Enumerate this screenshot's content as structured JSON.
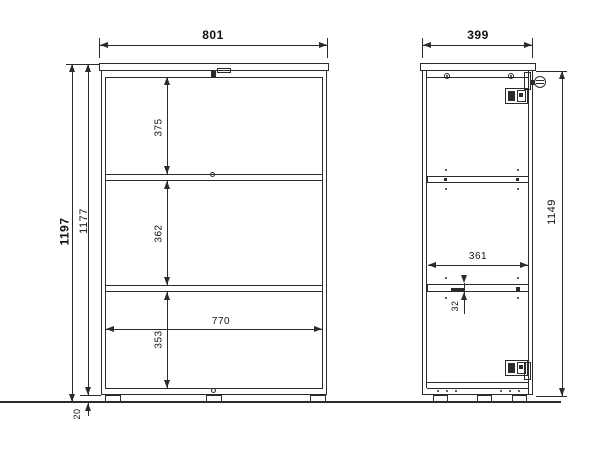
{
  "drawing": {
    "colors": {
      "background": "#ffffff",
      "line": "#2b2b2b",
      "text": "#111111"
    },
    "front_view": {
      "width": "801",
      "inner_width": "770",
      "total_height": "1197",
      "carcass_height": "1177",
      "top_section_height": "375",
      "middle_section_height": "362",
      "bottom_section_height": "353",
      "foot_height": "20"
    },
    "side_view": {
      "depth": "399",
      "inner_height": "1149",
      "inner_depth": "361",
      "hole_pitch": "32"
    },
    "hardware_icons": [
      "cam-lock-icon",
      "hinge-icon",
      "door-bumper-icon",
      "screw-icon",
      "shelf-pin-hole-icon",
      "adjustable-foot-icon"
    ]
  }
}
